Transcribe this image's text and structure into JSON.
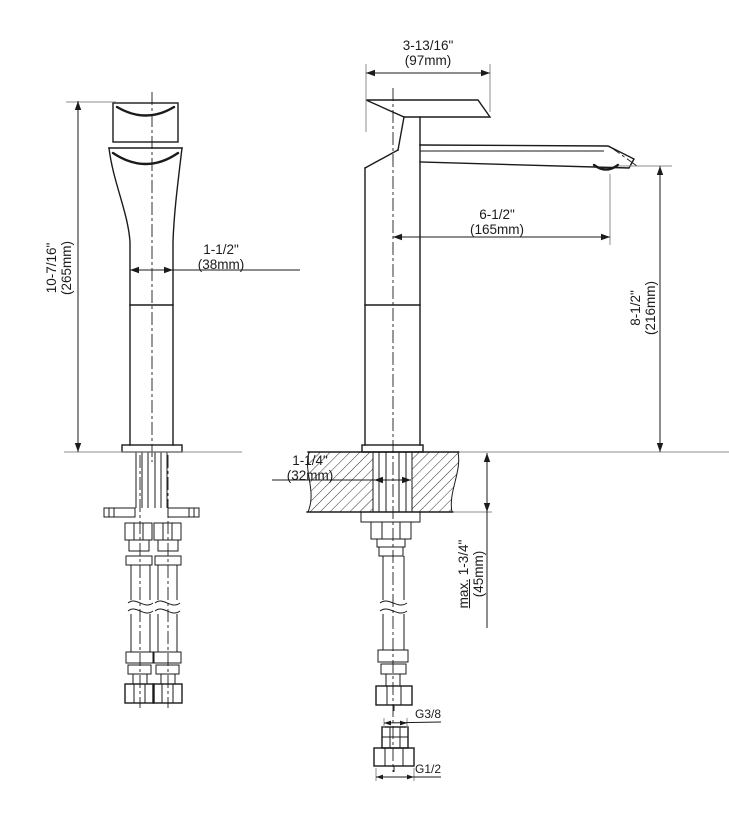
{
  "drawing": {
    "kind": "single-hole vessel faucet dimensional drawing",
    "views": [
      "front-view",
      "side-view",
      "connector-detail"
    ]
  },
  "dims": {
    "handle_reach": {
      "inches": "3-13/16\"",
      "mm": "(97mm)"
    },
    "total_height": {
      "inches": "10-7/16\"",
      "mm": "(265mm)"
    },
    "body_width": {
      "inches": "1-1/2\"",
      "mm": "(38mm)"
    },
    "spout_reach": {
      "inches": "6-1/2\"",
      "mm": "(165mm)"
    },
    "outlet_height": {
      "inches": "8-1/2\"",
      "mm": "(216mm)"
    },
    "mounting_hole": {
      "inches": "1-1/4\"",
      "mm": "(32mm)"
    },
    "deck_thickness": {
      "prefix": "max.",
      "inches": "1-3/4\"",
      "mm": "(45mm)"
    }
  },
  "connections": {
    "upper_thread": "G3/8",
    "lower_thread": "G1/2"
  },
  "colors": {
    "line_color": "#1b1b1b",
    "ext_color": "#8d8d8d",
    "bg": "#ffffff"
  }
}
